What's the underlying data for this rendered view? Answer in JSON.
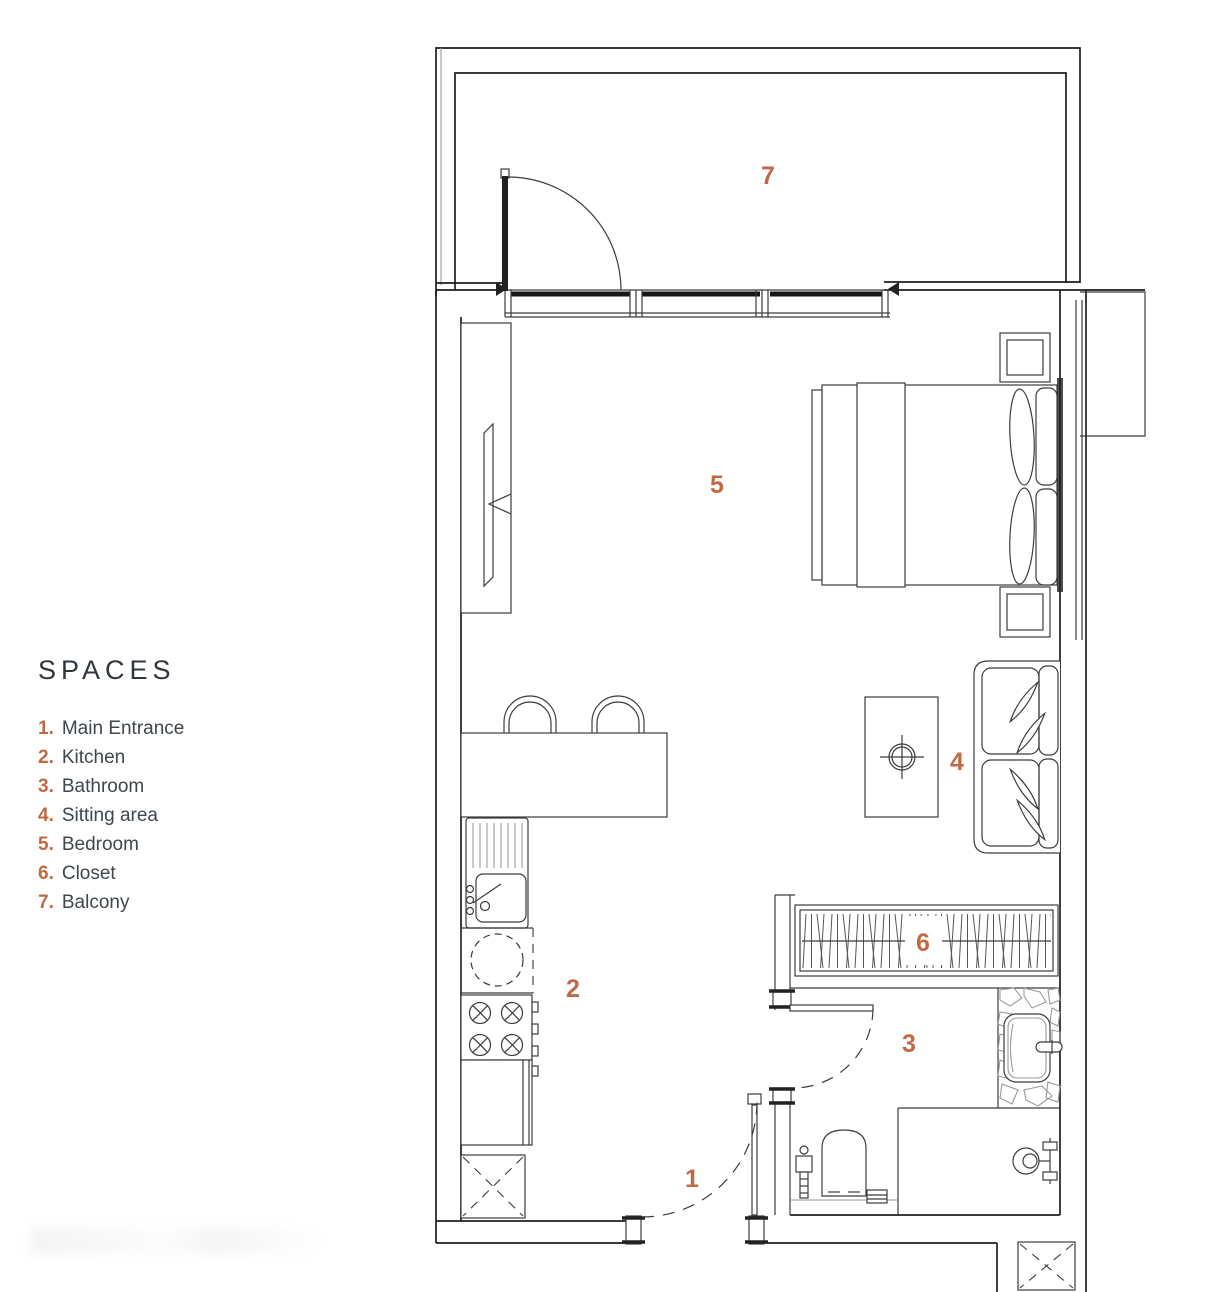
{
  "page": {
    "background": "#ffffff"
  },
  "legend": {
    "title": "SPACES",
    "items": [
      {
        "number": "1.",
        "label": "Main Entrance"
      },
      {
        "number": "2.",
        "label": "Kitchen"
      },
      {
        "number": "3.",
        "label": "Bathroom"
      },
      {
        "number": "4.",
        "label": "Sitting area"
      },
      {
        "number": "5.",
        "label": "Bedroom"
      },
      {
        "number": "6.",
        "label": "Closet"
      },
      {
        "number": "7.",
        "label": "Balcony"
      }
    ]
  },
  "plan": {
    "room_labels": [
      {
        "number": "1",
        "name": "Main Entrance"
      },
      {
        "number": "2",
        "name": "Kitchen"
      },
      {
        "number": "3",
        "name": "Bathroom"
      },
      {
        "number": "4",
        "name": "Sitting area"
      },
      {
        "number": "5",
        "name": "Bedroom"
      },
      {
        "number": "6",
        "name": "Closet"
      },
      {
        "number": "7",
        "name": "Balcony"
      }
    ],
    "colors": {
      "accent": "#c06a43",
      "line": "#3c3c3c",
      "line_dark": "#1e1e1e",
      "line_light": "#9a9a9a"
    }
  }
}
